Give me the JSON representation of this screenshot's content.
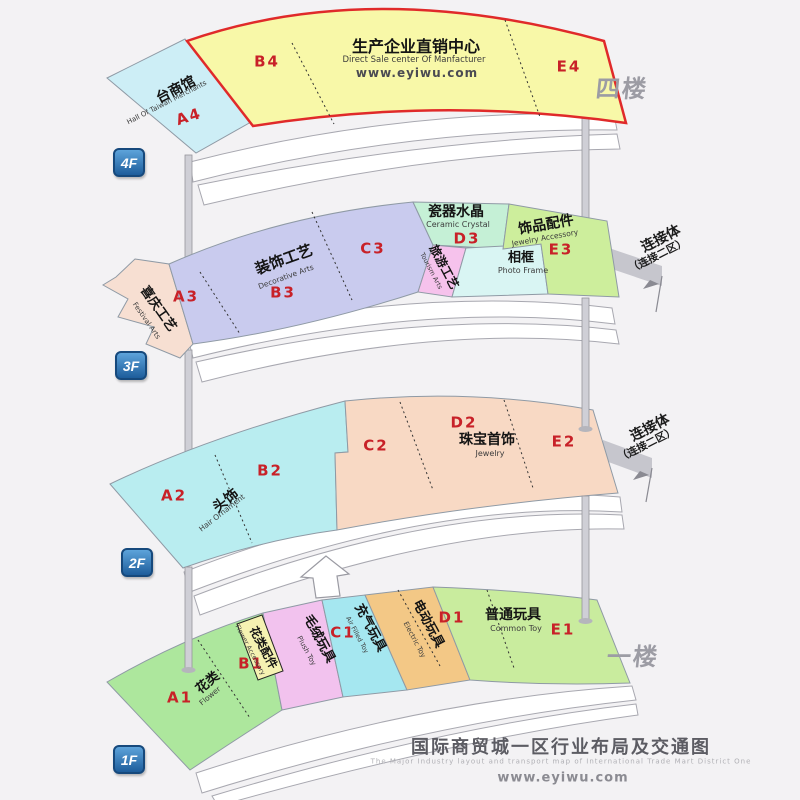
{
  "colors": {
    "f4_main": "#f8f8a8",
    "f4_taiwan": "#cdeef6",
    "f3_festival": "#f7dfd2",
    "f3_decorative": "#c9cbee",
    "f3_ceramic": "#c5f0d6",
    "f3_tourism": "#f6c2ec",
    "f3_photo": "#d9f5f3",
    "f3_jewelry_acc": "#cdee9c",
    "f2_hair": "#b9edf0",
    "f2_jewelry": "#f8d9c4",
    "f1_flower": "#ade79d",
    "f1_flower_acc": "#f5f2b2",
    "f1_plush": "#f2c2ee",
    "f1_air": "#a5e7f0",
    "f1_electric": "#f3c886",
    "f1_common": "#c9ec9e",
    "roof": "#ffffff",
    "pole": "#cfcfd6",
    "bridge": "#c6c6cd",
    "code_red": "#c82128",
    "badge_blue": "#1d5d9b",
    "border_red": "#e02a2a",
    "side_gray": "#9c9ca4"
  },
  "floors": {
    "f4": {
      "badge": "4F",
      "side": "四楼",
      "taiwan": {
        "zh": "台商馆",
        "en": "Hall Of Taiwan Merchants",
        "code": "A4"
      },
      "main": {
        "zh": "生产企业直销中心",
        "en": "Direct Sale center Of Manfacturer",
        "url": "www.eyiwu.com",
        "code_b": "B4",
        "code_e": "E4"
      }
    },
    "f3": {
      "badge": "3F",
      "connector": {
        "zh": "连接体",
        "sub": "（连接二区）"
      },
      "festival": {
        "zh": "喜庆工艺",
        "en": "Festival Arts",
        "code": "A3"
      },
      "decorative": {
        "zh": "装饰工艺",
        "en": "Decorative Arts",
        "code_b": "B3",
        "code_c": "C3"
      },
      "ceramic": {
        "zh": "瓷器水晶",
        "en": "Ceramic Crystal",
        "code": "D3"
      },
      "tourism": {
        "zh": "旅游工艺",
        "en": "Tourism Arts"
      },
      "photo": {
        "zh": "相框",
        "en": "Photo Frame"
      },
      "jewelry_acc": {
        "zh": "饰品配件",
        "en": "Jewelry Accessory",
        "code": "E3"
      }
    },
    "f2": {
      "badge": "2F",
      "connector": {
        "zh": "连接体",
        "sub": "（连接二区）"
      },
      "hair": {
        "zh": "头饰",
        "en": "Hair Ornament",
        "code_a": "A2",
        "code_b": "B2",
        "code_c": "C2"
      },
      "jewelry": {
        "zh": "珠宝首饰",
        "en": "Jewelry",
        "code_d": "D2",
        "code_e": "E2"
      }
    },
    "f1": {
      "badge": "1F",
      "side": "一楼",
      "flower": {
        "zh": "花类",
        "en": "Flower",
        "code": "A1"
      },
      "flower_acc": {
        "zh": "花类配件",
        "en": "Flower Accessory",
        "code": "B1"
      },
      "plush": {
        "zh": "毛绒玩具",
        "en": "Plush Toy"
      },
      "air": {
        "zh": "充气玩具",
        "en": "Air Filled Toy",
        "code": "C1"
      },
      "electric": {
        "zh": "电动玩具",
        "en": "Electric Toy",
        "code": "D1"
      },
      "common": {
        "zh": "普通玩具",
        "en": "Common Toy",
        "code": "E1"
      }
    }
  },
  "footer": {
    "title": "国际商贸城一区行业布局及交通图",
    "subtitle": "The Major Industry layout and transport map of International Trade Mart District One",
    "url": "www.eyiwu.com"
  }
}
